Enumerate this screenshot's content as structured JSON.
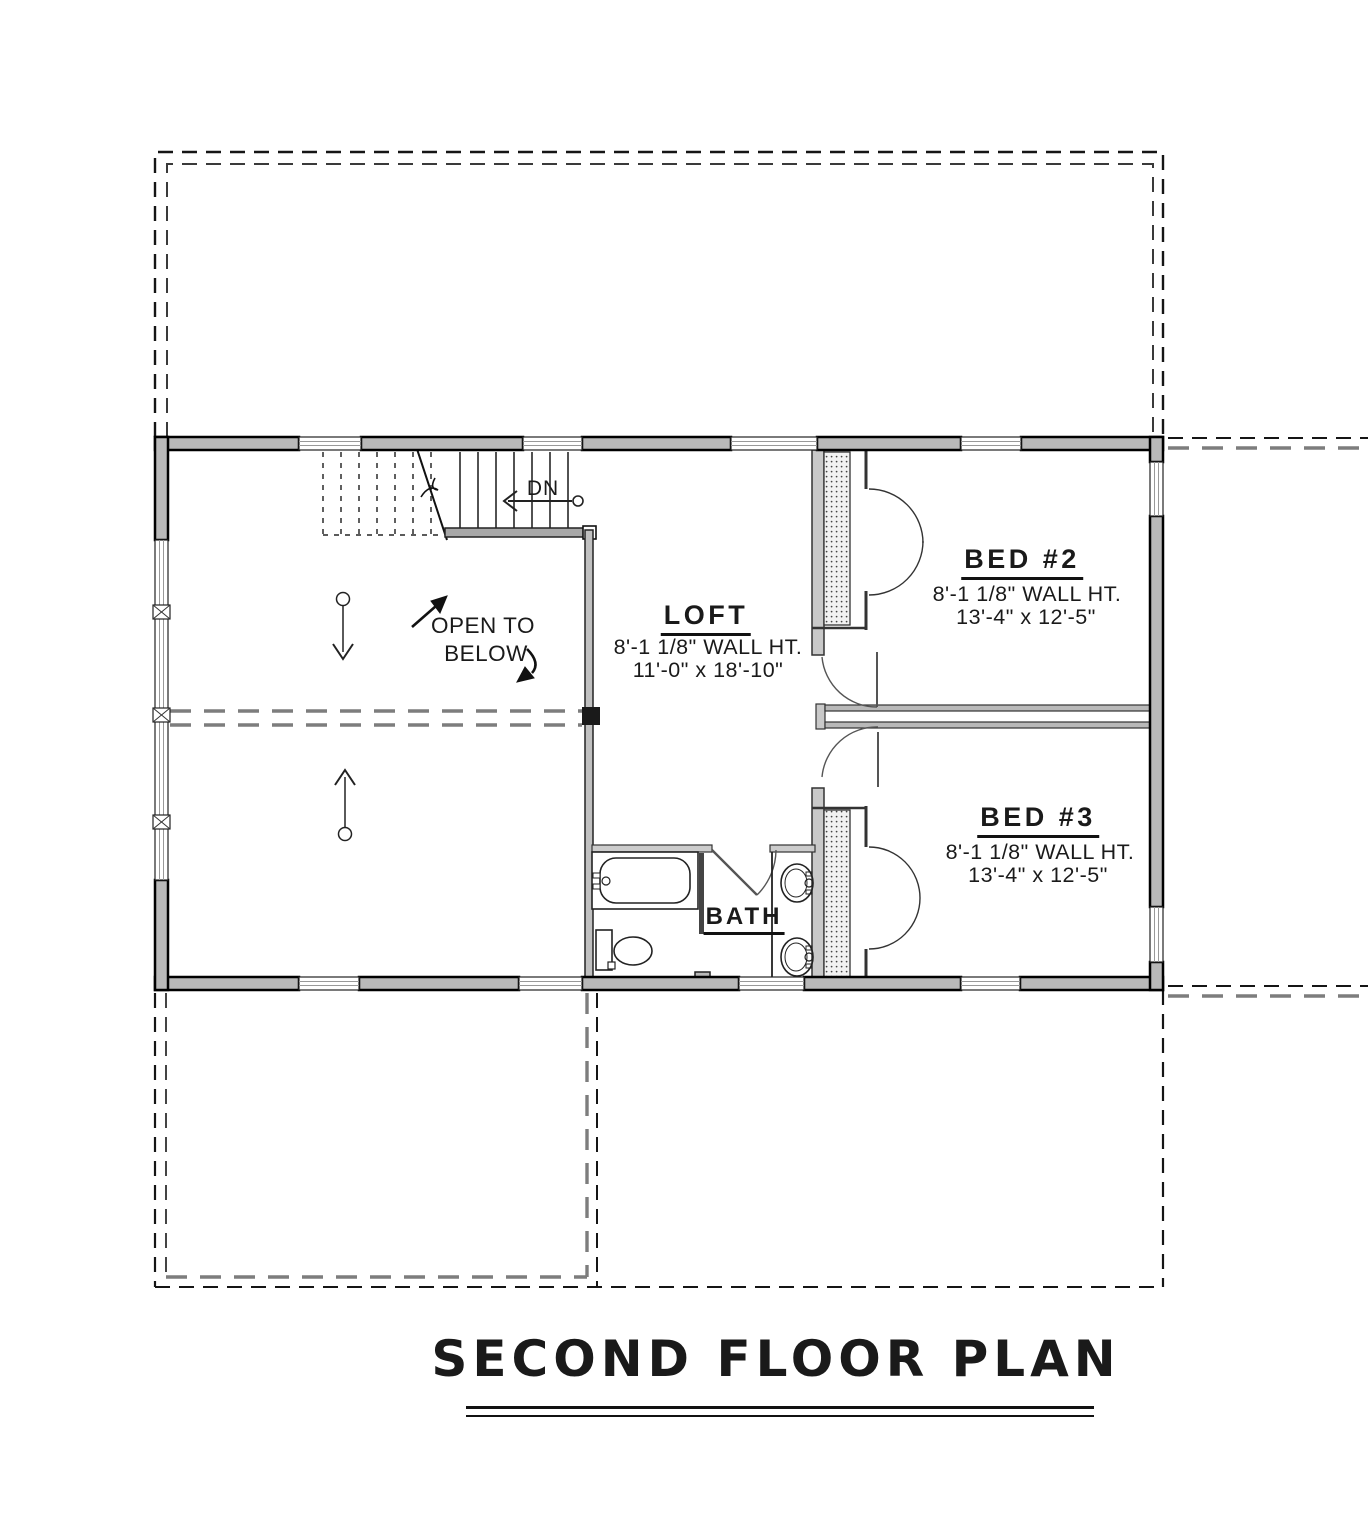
{
  "drawing_title": {
    "label": "SECOND FLOOR PLAN"
  },
  "rooms": {
    "loft": {
      "name": "LOFT",
      "wall_height": "8'-1 1/8\" WALL HT.",
      "size": "11'-0\" x 18'-10\""
    },
    "bed2": {
      "name": "BED #2",
      "wall_height": "8'-1 1/8\" WALL HT.",
      "size": "13'-4\" x 12'-5\""
    },
    "bed3": {
      "name": "BED #3",
      "wall_height": "8'-1 1/8\" WALL HT.",
      "size": "13'-4\" x 12'-5\""
    },
    "bath": {
      "name": "BATH"
    }
  },
  "annotations": {
    "stair_direction": "DN",
    "open_to_below_line1": "OPEN TO",
    "open_to_below_line2": "BELOW"
  },
  "colors": {
    "wall_fill": "#b9b9b9",
    "line_black": "#111111",
    "dash_gray": "#7d7d7d"
  }
}
